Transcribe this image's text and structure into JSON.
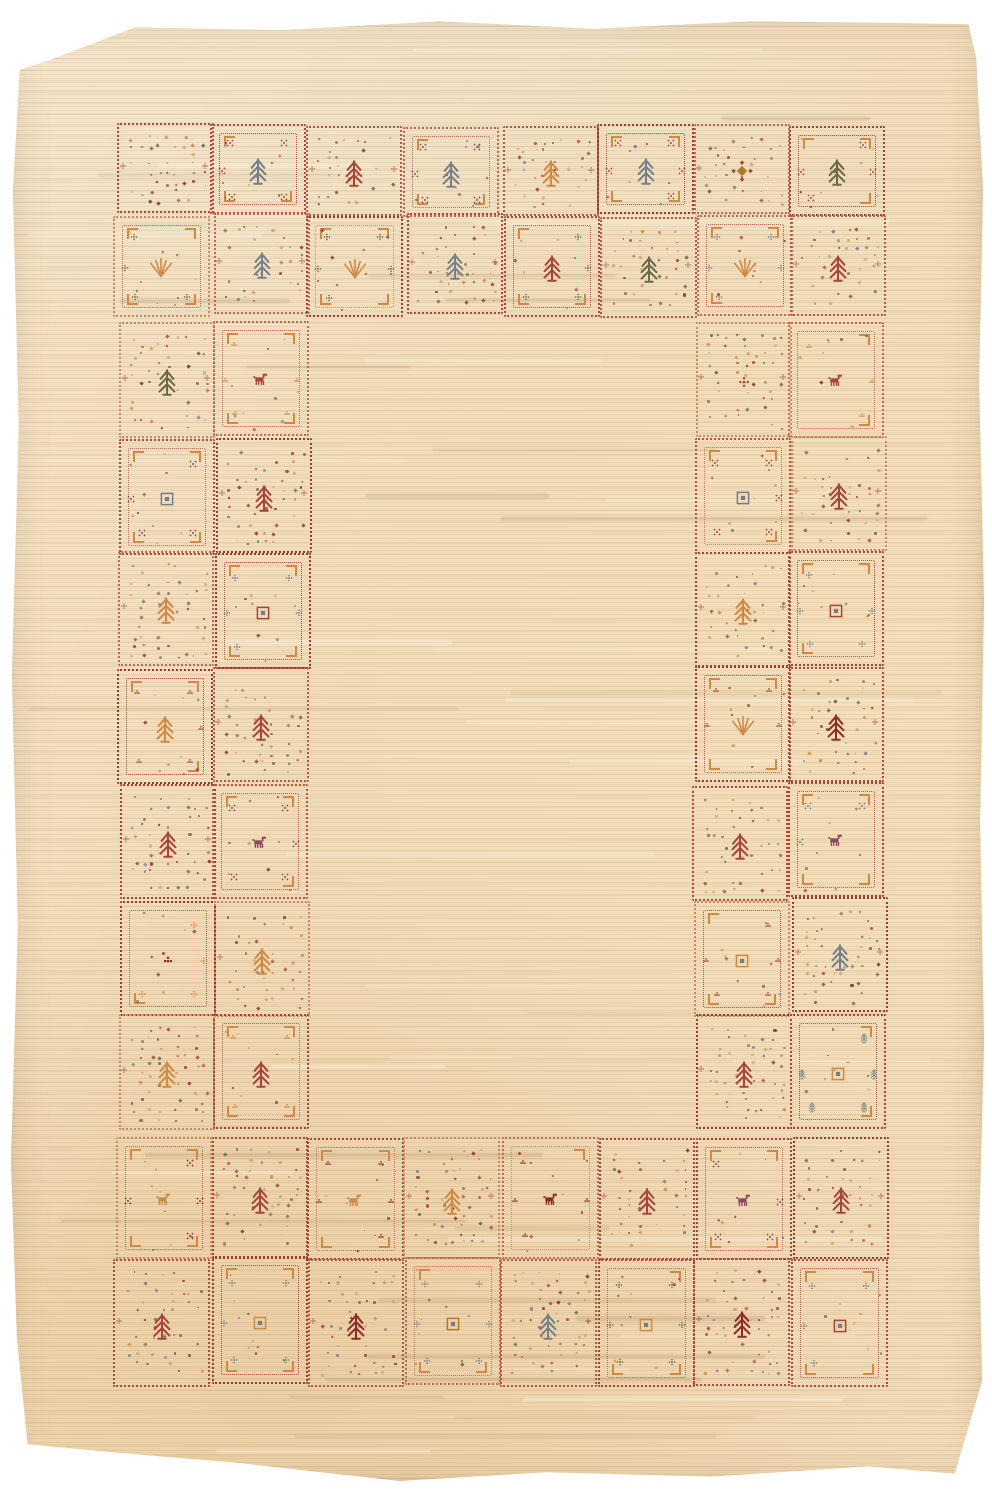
{
  "alt": "Photograph of a cream gabbeh-style wool rug; open plain field framed by a border of small dotted squares woven with tribal motifs (trees, stars, brackets, nested squares, animals)",
  "palette": {
    "page": "#ffffff",
    "field": "#f2dcb8",
    "fieldLight": "#f7e9cf",
    "fieldDark": "#e9d0a9",
    "red": "#a8453a",
    "darkred": "#8c2e26",
    "orange": "#cf8a45",
    "gold": "#b07a2e",
    "olive": "#6b6a48",
    "gray": "#77808a",
    "purple": "#8a4a5e",
    "green": "#5d7042",
    "tan": "#c9a878",
    "borderReds": [
      "#b04a3c",
      "#a8453a",
      "#9d3b30",
      "#c0685a",
      "#b85948",
      "#c88a64"
    ]
  },
  "rug": {
    "offset": {
      "left": 8,
      "top": 14,
      "width": 978,
      "height": 1470
    },
    "layout": {
      "top": {
        "x": 115,
        "y": 125,
        "cols": 8,
        "cellW": 96.6,
        "rowHeights": [
          90,
          101
        ]
      },
      "bottom": {
        "x": 115,
        "y": 1136,
        "cols": 8,
        "cellW": 96.6,
        "rowHeights": [
          122,
          128
        ]
      },
      "left": {
        "x": 118,
        "y": 322,
        "rows": 7,
        "cellH": 115.4,
        "colWidths": [
          96,
          96
        ]
      },
      "right": {
        "x": 694,
        "y": 322,
        "rows": 7,
        "cellH": 115.4,
        "colWidths": [
          96,
          96
        ]
      }
    },
    "cells": {
      "top": [
        [
          {
            "t": "sp",
            "m": "none"
          },
          {
            "t": "br",
            "m": "tree",
            "c": "gray",
            "a": "xstar",
            "ac": "red"
          },
          {
            "t": "sp",
            "m": "tree",
            "c": "red"
          },
          {
            "t": "br",
            "m": "tree",
            "c": "gray",
            "a": "xstar",
            "ac": "purple"
          },
          {
            "t": "sp",
            "m": "tree",
            "c": "orange"
          },
          {
            "t": "br",
            "m": "tree",
            "c": "gray",
            "a": "xstar",
            "ac": "red"
          },
          {
            "t": "sp",
            "m": "diamond",
            "c": "gold"
          },
          {
            "t": "br",
            "m": "tree",
            "c": "olive",
            "a": "xstar",
            "ac": "red"
          }
        ],
        [
          {
            "t": "br",
            "m": "fan",
            "c": "orange",
            "a": "cross",
            "ac": "olive"
          },
          {
            "t": "sp",
            "m": "tree",
            "c": "gray"
          },
          {
            "t": "br",
            "m": "fan",
            "c": "orange",
            "a": "cross",
            "ac": "olive"
          },
          {
            "t": "sp",
            "m": "tree",
            "c": "gray"
          },
          {
            "t": "br",
            "m": "tree",
            "c": "red",
            "a": "cross",
            "ac": "olive"
          },
          {
            "t": "sp",
            "m": "tree",
            "c": "olive"
          },
          {
            "t": "br",
            "m": "fan",
            "c": "orange",
            "a": "cross",
            "ac": "gray"
          },
          {
            "t": "sp",
            "m": "tree",
            "c": "red"
          }
        ]
      ],
      "left": [
        [
          {
            "t": "sp",
            "m": "tree",
            "c": "olive"
          },
          {
            "t": "br",
            "m": "animal",
            "c": "red",
            "a": "blocks",
            "ac": "orange"
          }
        ],
        [
          {
            "t": "br",
            "m": "nsq",
            "c": "gray",
            "a": "xstar",
            "ac": "purple"
          },
          {
            "t": "sp",
            "m": "tree",
            "c": "red"
          }
        ],
        [
          {
            "t": "sp",
            "m": "tree",
            "c": "orange"
          },
          {
            "t": "br",
            "m": "nsq",
            "c": "red",
            "a": "cross",
            "ac": "gray"
          }
        ],
        [
          {
            "t": "br",
            "m": "tree",
            "c": "orange",
            "a": "blocks",
            "ac": "red"
          },
          {
            "t": "sp",
            "m": "tree",
            "c": "red"
          }
        ],
        [
          {
            "t": "sp",
            "m": "tree",
            "c": "red"
          },
          {
            "t": "br",
            "m": "animal",
            "c": "purple",
            "a": "xstar",
            "ac": "purple"
          }
        ],
        [
          {
            "t": "br",
            "m": "blocks",
            "c": "darkred",
            "a": "cross",
            "ac": "orange"
          },
          {
            "t": "sp",
            "m": "tree",
            "c": "orange"
          }
        ],
        [
          {
            "t": "sp",
            "m": "tree",
            "c": "orange"
          },
          {
            "t": "br",
            "m": "tree",
            "c": "red",
            "a": "blocks",
            "ac": "orange"
          }
        ]
      ],
      "right": [
        [
          {
            "t": "sp",
            "m": "cross",
            "c": "red"
          },
          {
            "t": "br",
            "m": "animal",
            "c": "red",
            "a": "blocks",
            "ac": "orange"
          }
        ],
        [
          {
            "t": "br",
            "m": "nsq",
            "c": "gray",
            "a": "xstar",
            "ac": "red"
          },
          {
            "t": "sp",
            "m": "tree",
            "c": "red"
          }
        ],
        [
          {
            "t": "sp",
            "m": "tree",
            "c": "orange"
          },
          {
            "t": "br",
            "m": "nsq",
            "c": "red",
            "a": "cross",
            "ac": "gray"
          }
        ],
        [
          {
            "t": "br",
            "m": "fan",
            "c": "orange",
            "a": "blocks",
            "ac": "red"
          },
          {
            "t": "sp",
            "m": "tree",
            "c": "darkred"
          }
        ],
        [
          {
            "t": "sp",
            "m": "tree",
            "c": "red"
          },
          {
            "t": "br",
            "m": "animal",
            "c": "purple",
            "a": "xstar",
            "ac": "gray"
          }
        ],
        [
          {
            "t": "br",
            "m": "nsq",
            "c": "orange",
            "a": "blocks",
            "ac": "red"
          },
          {
            "t": "sp",
            "m": "tree",
            "c": "gray"
          }
        ],
        [
          {
            "t": "sp",
            "m": "tree",
            "c": "red"
          },
          {
            "t": "br",
            "m": "nsq",
            "c": "orange",
            "a": "tree",
            "ac": "gray"
          }
        ]
      ],
      "bottom": [
        [
          {
            "t": "br",
            "m": "animal",
            "c": "orange",
            "a": "xstar",
            "ac": "darkred"
          },
          {
            "t": "sp",
            "m": "tree",
            "c": "red"
          },
          {
            "t": "br",
            "m": "animal",
            "c": "orange",
            "a": "blocks",
            "ac": "darkred"
          },
          {
            "t": "sp",
            "m": "tree",
            "c": "orange"
          },
          {
            "t": "br",
            "m": "animal",
            "c": "darkred",
            "a": "blocks",
            "ac": "darkred"
          },
          {
            "t": "sp",
            "m": "tree",
            "c": "red"
          },
          {
            "t": "br",
            "m": "animal",
            "c": "purple",
            "a": "xstar",
            "ac": "purple"
          },
          {
            "t": "sp",
            "m": "tree",
            "c": "red"
          }
        ],
        [
          {
            "t": "sp",
            "m": "tree",
            "c": "red"
          },
          {
            "t": "br",
            "m": "nsq",
            "c": "orange",
            "a": "cross",
            "ac": "gray"
          },
          {
            "t": "sp",
            "m": "tree",
            "c": "darkred"
          },
          {
            "t": "br",
            "m": "nsq",
            "c": "gold",
            "a": "cross",
            "ac": "gray"
          },
          {
            "t": "sp",
            "m": "tree",
            "c": "gray"
          },
          {
            "t": "br",
            "m": "nsq",
            "c": "orange",
            "a": "cross",
            "ac": "olive"
          },
          {
            "t": "sp",
            "m": "tree",
            "c": "darkred"
          },
          {
            "t": "br",
            "m": "nsq",
            "c": "red",
            "a": "cross",
            "ac": "gray"
          }
        ]
      ]
    }
  }
}
